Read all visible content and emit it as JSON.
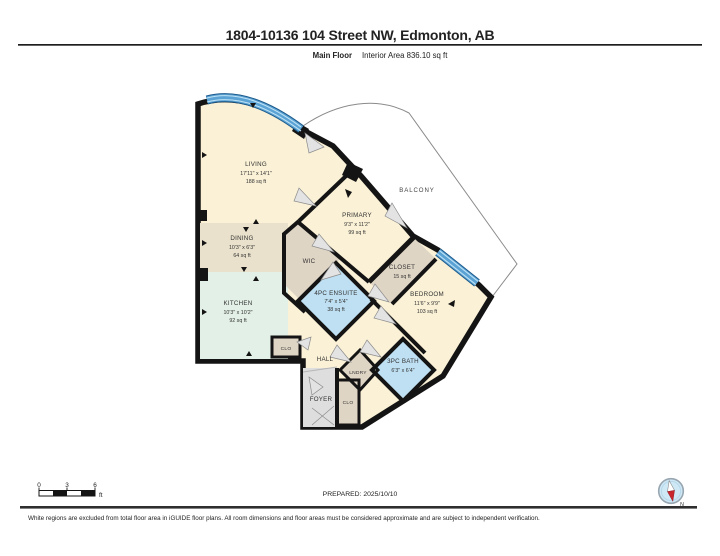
{
  "header": {
    "title": "1804-10136 104 Street NW, Edmonton, AB",
    "floor_label": "Main Floor",
    "area_label": "Interior Area 836.10 sq ft"
  },
  "rooms": {
    "living": {
      "name": "LIVING",
      "dims": "17'11\" x 14'1\"",
      "area": "188 sq ft"
    },
    "dining": {
      "name": "DINING",
      "dims": "10'3\" x 6'3\"",
      "area": "64 sq ft"
    },
    "kitchen": {
      "name": "KITCHEN",
      "dims": "10'3\" x 10'2\"",
      "area": "92 sq ft"
    },
    "primary": {
      "name": "PRIMARY",
      "dims": "9'3\" x 11'2\"",
      "area": "99 sq ft"
    },
    "wic": {
      "name": "WIC"
    },
    "closet": {
      "name": "CLOSET",
      "area": "15 sq ft"
    },
    "bedroom": {
      "name": "BEDROOM",
      "dims": "11'6\" x 9'9\"",
      "area": "103 sq ft"
    },
    "ensuite": {
      "name": "4PC ENSUITE",
      "dims": "7'4\" x 5'4\"",
      "area": "38 sq ft"
    },
    "bath": {
      "name": "3PC BATH",
      "dims": "6'3\" x 6'4\""
    },
    "hall": {
      "name": "HALL"
    },
    "lndry": {
      "name": "LNDRY"
    },
    "foyer": {
      "name": "FOYER"
    },
    "clo_hall": {
      "name": "CLO"
    },
    "clo_foyer": {
      "name": "CLO"
    },
    "balcony": {
      "name": "BALCONY"
    }
  },
  "scale_bar": {
    "tick_0": "0",
    "tick_3": "3",
    "tick_6": "6",
    "unit": "ft"
  },
  "prepared_label": "PREPARED: 2025/10/10",
  "compass": {
    "north_label": "N"
  },
  "footer": {
    "disclaimer": "White regions are excluded from total floor area in iGUIDE floor plans. All room dimensions and floor areas must be considered approximate and are subject to independent verification."
  },
  "colors": {
    "wall": "#141414",
    "window_blue": "#5BA3D4",
    "room_cream": "#FAF1D6",
    "room_tan": "#E9E1CB",
    "room_mint": "#E3F0E7",
    "room_taupe": "#DFD5C5",
    "room_blue": "#BFE0F3",
    "room_gray": "#DEDEDE"
  }
}
